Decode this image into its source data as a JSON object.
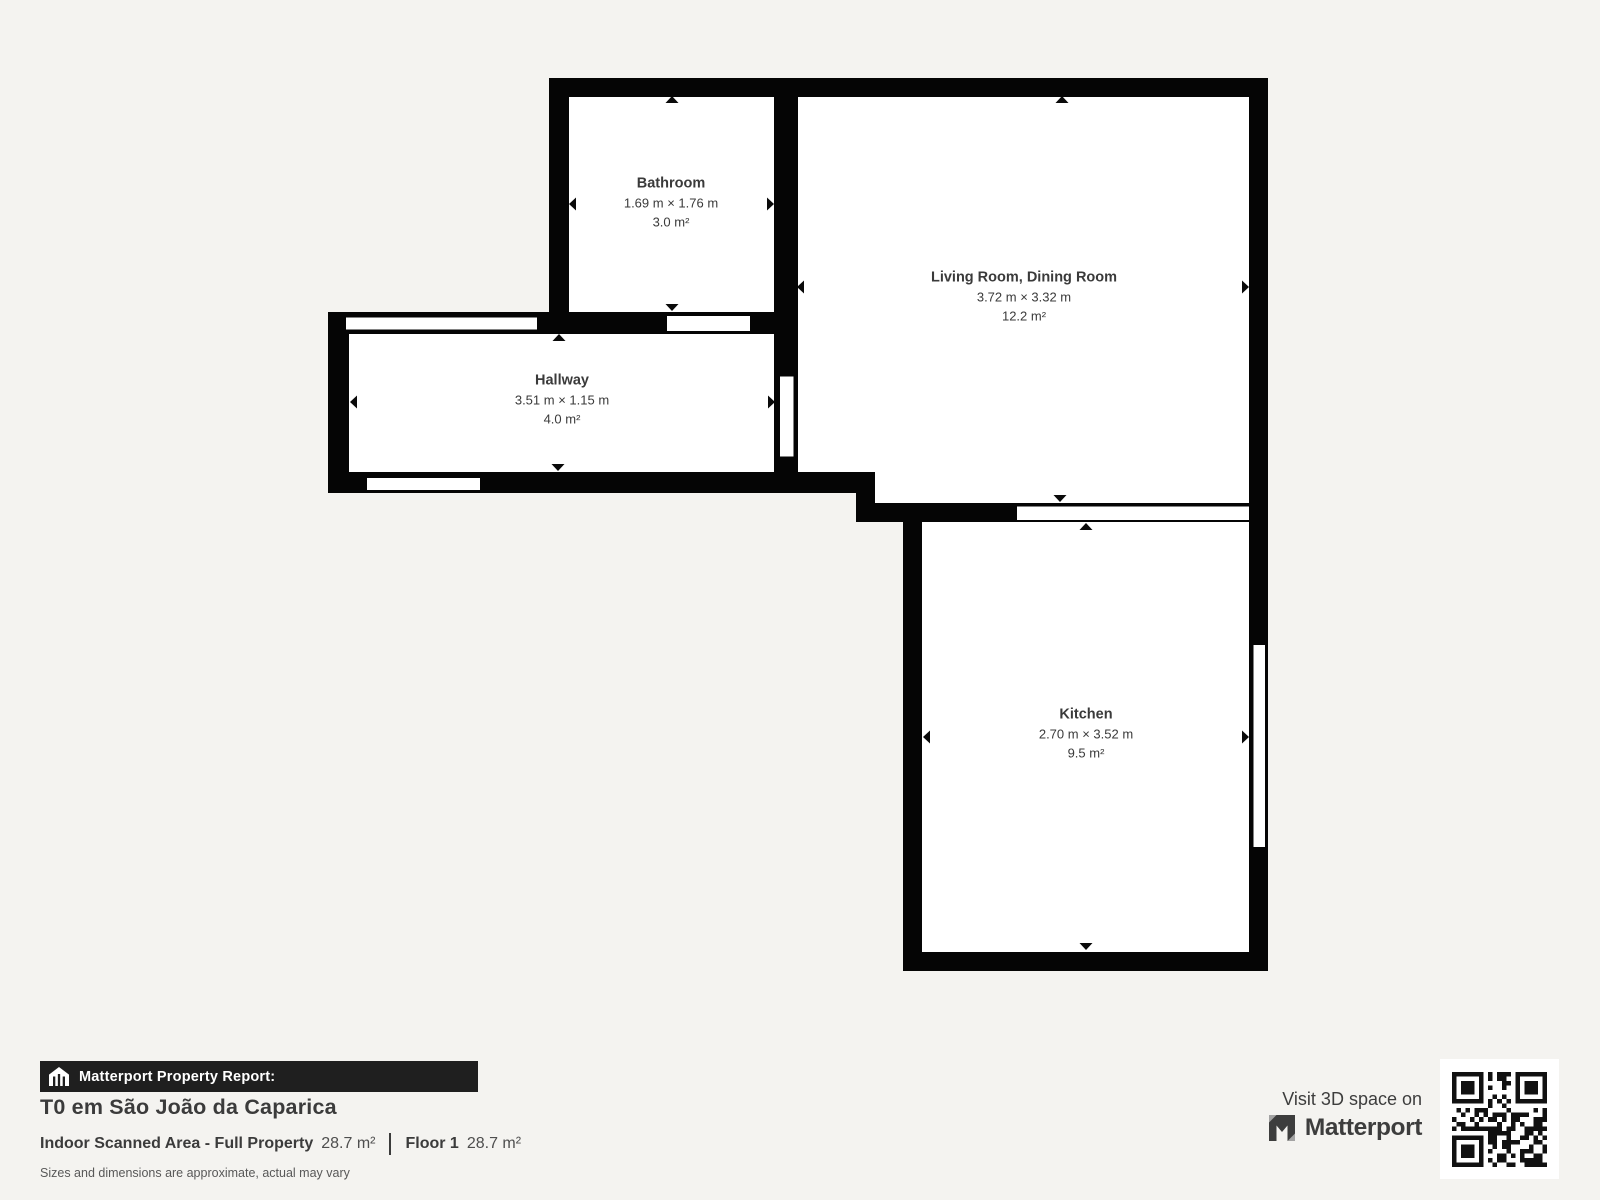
{
  "page": {
    "background_color": "#f4f3f0"
  },
  "floorplan": {
    "wall_color": "#050505",
    "room_fill": "#ffffff",
    "label_color": "#3a3a3a",
    "rooms": [
      {
        "name": "Bathroom",
        "dimensions": "1.69 m × 1.76 m",
        "area": "3.0 m²"
      },
      {
        "name": "Living Room, Dining Room",
        "dimensions": "3.72 m × 3.32 m",
        "area": "12.2 m²"
      },
      {
        "name": "Hallway",
        "dimensions": "3.51 m × 1.15 m",
        "area": "4.0 m²"
      },
      {
        "name": "Kitchen",
        "dimensions": "2.70 m × 3.52 m",
        "area": "9.5 m²"
      }
    ]
  },
  "report": {
    "bar_label": "Matterport Property Report:",
    "title": "T0 em São João da Caparica",
    "stats": [
      {
        "label": "Indoor Scanned Area - Full Property",
        "value": "28.7 m²"
      },
      {
        "label": "Floor 1",
        "value": "28.7 m²"
      }
    ],
    "disclaimer": "Sizes and dimensions are approximate, actual may vary"
  },
  "promo": {
    "visit_text": "Visit 3D space on",
    "brand": "Matterport"
  },
  "icons": {
    "report_bar": "house-icon",
    "brand_mark": "matterport-logo-icon",
    "qr": "qr-code"
  }
}
